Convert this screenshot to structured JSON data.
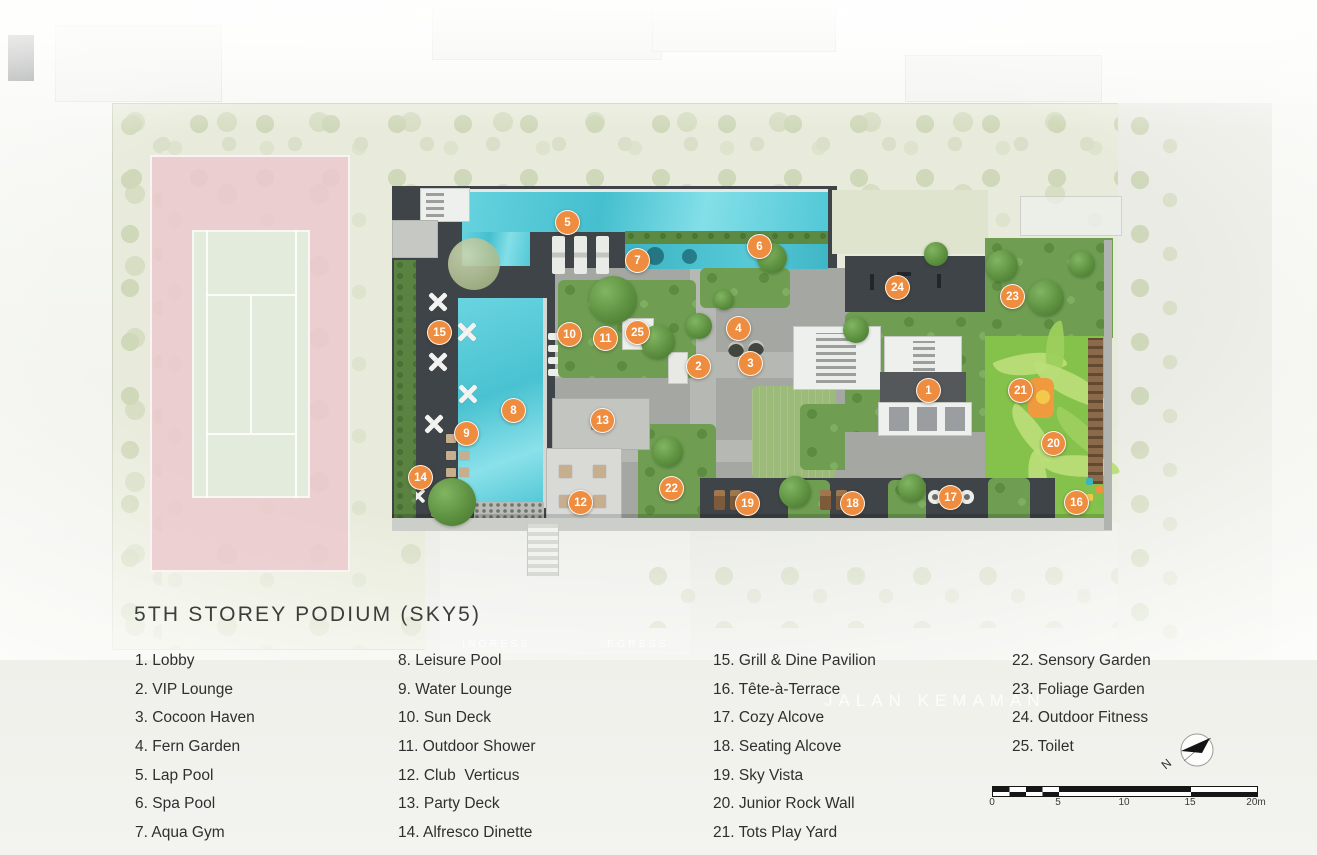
{
  "title": "5TH STOREY PODIUM (SKY5)",
  "plan": {
    "road_label": "JALAN KEMAMAN",
    "ingress_label": "INGRESS",
    "egress_label": "EGRESS",
    "markers": [
      {
        "n": "1",
        "x": 928,
        "y": 390
      },
      {
        "n": "2",
        "x": 698,
        "y": 366
      },
      {
        "n": "3",
        "x": 750,
        "y": 363
      },
      {
        "n": "4",
        "x": 738,
        "y": 328
      },
      {
        "n": "5",
        "x": 567,
        "y": 222
      },
      {
        "n": "6",
        "x": 759,
        "y": 246
      },
      {
        "n": "7",
        "x": 637,
        "y": 260
      },
      {
        "n": "8",
        "x": 513,
        "y": 410
      },
      {
        "n": "9",
        "x": 466,
        "y": 433
      },
      {
        "n": "10",
        "x": 569,
        "y": 334
      },
      {
        "n": "11",
        "x": 605,
        "y": 338
      },
      {
        "n": "12",
        "x": 580,
        "y": 502
      },
      {
        "n": "13",
        "x": 602,
        "y": 420
      },
      {
        "n": "14",
        "x": 420,
        "y": 477
      },
      {
        "n": "15",
        "x": 439,
        "y": 332
      },
      {
        "n": "16",
        "x": 1076,
        "y": 502
      },
      {
        "n": "17",
        "x": 950,
        "y": 497
      },
      {
        "n": "18",
        "x": 852,
        "y": 503
      },
      {
        "n": "19",
        "x": 747,
        "y": 503
      },
      {
        "n": "20",
        "x": 1053,
        "y": 443
      },
      {
        "n": "21",
        "x": 1020,
        "y": 390
      },
      {
        "n": "22",
        "x": 671,
        "y": 488
      },
      {
        "n": "23",
        "x": 1012,
        "y": 296
      },
      {
        "n": "24",
        "x": 897,
        "y": 287
      },
      {
        "n": "25",
        "x": 637,
        "y": 332
      }
    ]
  },
  "legend": {
    "columns": [
      [
        "1. Lobby",
        "2. VIP Lounge",
        "3. Cocoon Haven",
        "4. Fern Garden",
        "5. Lap Pool",
        "6. Spa Pool",
        "7. Aqua Gym"
      ],
      [
        "8. Leisure Pool",
        "9. Water Lounge",
        "10. Sun Deck",
        "11. Outdoor Shower",
        "12. Club  Verticus",
        "13. Party Deck",
        "14. Alfresco Dinette"
      ],
      [
        "15. Grill & Dine Pavilion",
        "16. Tête-à-Terrace",
        "17. Cozy Alcove",
        "18. Seating Alcove",
        "19. Sky Vista",
        "20. Junior Rock Wall",
        "21. Tots Play Yard"
      ],
      [
        "22. Sensory Garden",
        "23. Foliage Garden",
        "24. Outdoor Fitness",
        "25. Toilet"
      ]
    ]
  },
  "compass": {
    "label": "N"
  },
  "scalebar": {
    "labels": [
      "0",
      "5",
      "10",
      "15",
      "20m"
    ]
  },
  "colors": {
    "marker": "#ee8c3f",
    "deck": "#3f4448",
    "pool": "#52c8d6",
    "playground": "#85c24c",
    "tennis": "#ebc8cd",
    "garden": "#6f9e52"
  }
}
